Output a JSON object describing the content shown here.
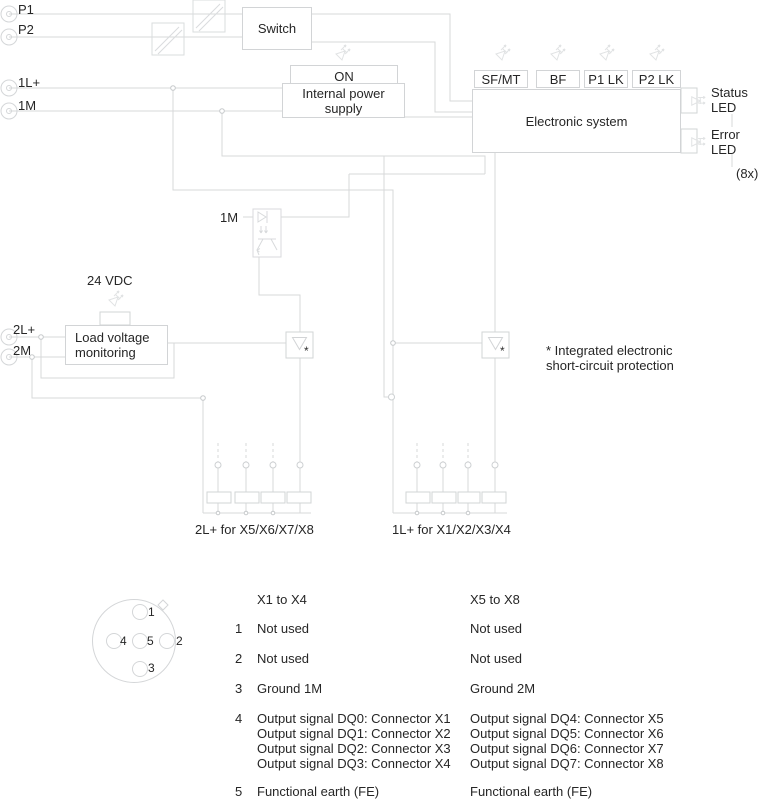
{
  "terminals": {
    "p1": "P1",
    "p2": "P2",
    "l1plus": "1L+",
    "m1": "1M",
    "l2plus": "2L+",
    "m2": "2M"
  },
  "blocks": {
    "switch": "Switch",
    "on": "ON",
    "internal_power": "Internal power\nsupply",
    "electronic_system": "Electronic system",
    "load_voltage": "Load voltage\nmonitoring",
    "sf_mt": "SF/MT",
    "bf": "BF",
    "p1_lk": "P1 LK",
    "p2_lk": "P2 LK"
  },
  "annotations": {
    "vdc": "24 VDC",
    "m1_opto": "1M",
    "status_led": "Status\nLED",
    "error_led": "Error\nLED",
    "count_8x": "(8x)",
    "footnote": "* Integrated electronic\nshort-circuit protection",
    "asterisk": "*",
    "bus_left": "2L+ for X5/X6/X7/X8",
    "bus_right": "1L+ for X1/X2/X3/X4"
  },
  "pinout": {
    "pins": [
      "1",
      "2",
      "3",
      "4",
      "5"
    ]
  },
  "pin_table": {
    "col1_header": "X1 to X4",
    "col2_header": "X5 to X8",
    "rows": [
      {
        "pin": "1",
        "x1_x4": "Not used",
        "x5_x8": "Not used"
      },
      {
        "pin": "2",
        "x1_x4": "Not used",
        "x5_x8": "Not used"
      },
      {
        "pin": "3",
        "x1_x4": "Ground 1M",
        "x5_x8": "Ground 2M"
      },
      {
        "pin": "4",
        "x1_x4": "Output signal DQ0: Connector X1\nOutput signal DQ1: Connector X2\nOutput signal DQ2: Connector X3\nOutput signal DQ3: Connector X4",
        "x5_x8": "Output signal DQ4: Connector X5\nOutput signal DQ5: Connector X6\nOutput signal DQ6: Connector X7\nOutput signal DQ7: Connector X8"
      },
      {
        "pin": "5",
        "x1_x4": "Functional earth (FE)",
        "x5_x8": "Functional earth (FE)"
      }
    ]
  },
  "colors": {
    "wire": "#d7d9da",
    "shape": "#d2d4d6",
    "led": "#e1e3e4",
    "text": "#262626"
  }
}
